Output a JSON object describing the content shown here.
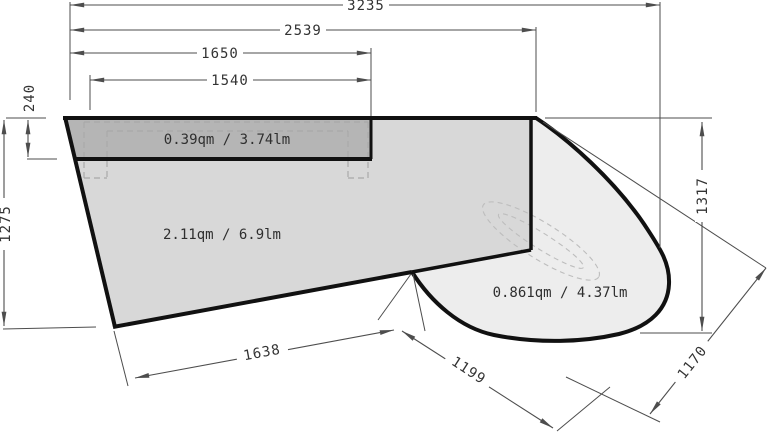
{
  "drawing": {
    "kind": "countertop-plan-dimension-drawing",
    "dims": {
      "d3235": "3235",
      "d2539": "2539",
      "d1650": "1650",
      "d1540": "1540",
      "d240": "240",
      "d1275": "1275",
      "d1317": "1317",
      "d1638": "1638",
      "d1199": "1199",
      "d1170": "1170"
    },
    "areas": {
      "strip": "0.39qm / 3.74lm",
      "main": "2.11qm / 6.9lm",
      "round": "0.861qm / 4.37lm"
    },
    "colors": {
      "strip_fill": "#b5b5b5",
      "main_fill": "#d8d8d8",
      "round_fill": "#ededed",
      "outline": "#111111",
      "dim_line": "#4d4d4d",
      "text": "#333333",
      "hidden_line": "#a9a9a9",
      "background": "#ffffff"
    }
  }
}
